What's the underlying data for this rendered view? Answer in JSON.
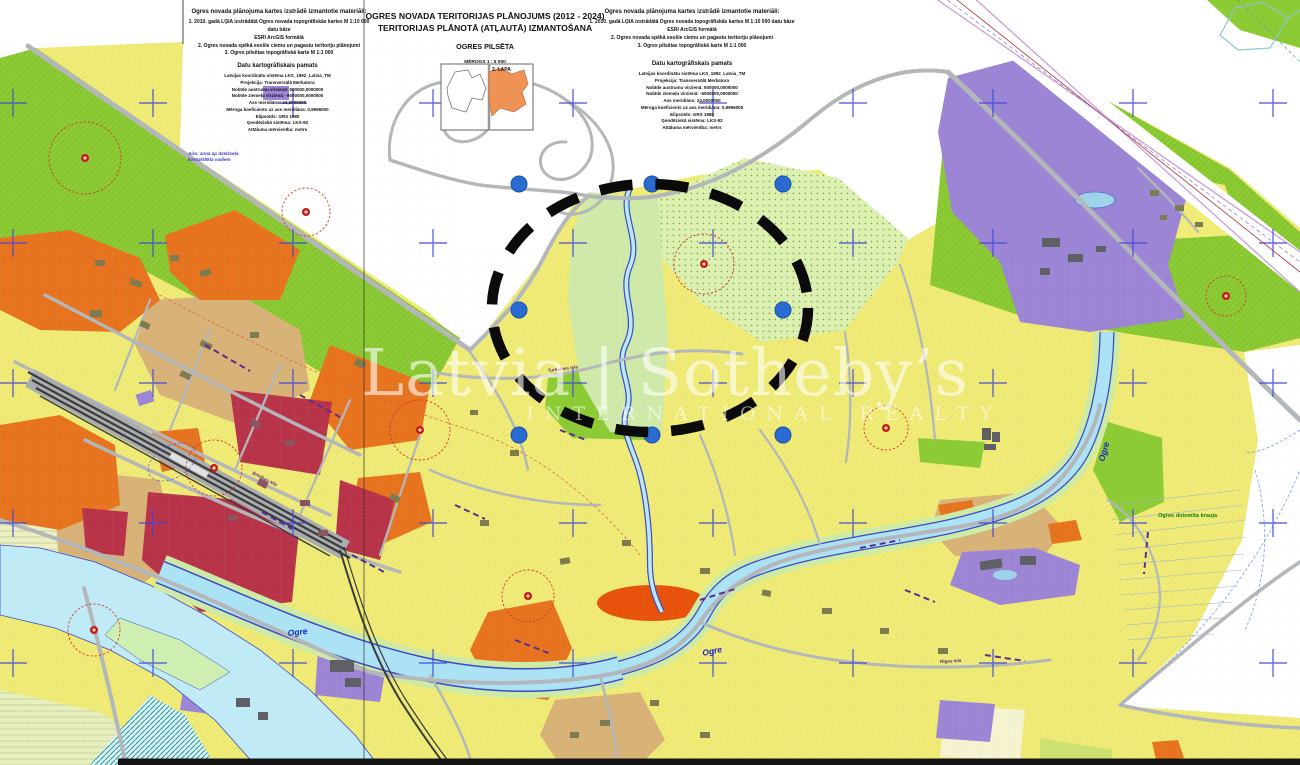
{
  "header": {
    "materials": {
      "title": "Ogres novada plānojuma kartes izstrādē izmantotie materiāli:",
      "lines": [
        "1. 2010. gadā LĢIA izstrādātā Ogres novada topogrāfiskās kartes M 1:10 000 datu bāze",
        "ESRI ArcGIS formātā",
        "2. Ogres novada spēkā esošie ciemu un pagastu teritoriju plānojumi",
        "3. Ogres pilsētas topogrāfiskā karte M 1:1 000"
      ]
    },
    "basis": {
      "title": "Datu kartogrāfiskais pamats",
      "lines": [
        "Latvijas koordinātu sistēma LKS_1992_Latvia_TM",
        "Projekcija: Transversālā Merkatora",
        "Nobīde austrumu virzienā: 500000,0000000",
        "Nobīde ziemeļu virzienā: -6000000,0000000",
        "Ass meridiāns: 24,0000000",
        "Mēroga koeficients uz ass meridiāna: 0,9996000",
        "Elipsoīds: GRS 1980",
        "Ģeodēziskā sistēma: LKS-92",
        "Attāluma mērvienība: metrs"
      ]
    },
    "title_block": {
      "line1": "OGRES NOVADA TERITORIJAS PLĀNOJUMS (2012 - 2024)",
      "line2": "TERITORIJAS PLĀNOTĀ (ATĻAUTĀ) IZMANTOŠANA",
      "subtitle": "OGRES PILSĒTA",
      "scale": "MĒROGS 1 : 5 000"
    },
    "inset_label": "2. LAPA"
  },
  "watermark": {
    "brand": "Latvia | Sotheby’s",
    "tagline": "INTERNATIONAL REALTY"
  },
  "map_labels": {
    "river_ogre_west": "Ogre",
    "river_ogre_mid": "Ogre",
    "river_ogre_east": "Ogre",
    "cliff": "Ogres dolomīta krauja",
    "note_line1": "Aizs. zona ap dzelzceļa",
    "note_line2": "kontakttīkla vadiem",
    "street_1": "Turkalnes iela",
    "street_2": "Brīvības iela",
    "street_3": "Rīgas iela"
  },
  "palette": {
    "residential_yellow": "#f0ec77",
    "greenery": "#8ccb33",
    "pale_green_dotted": "#ddf0b2",
    "mixed_orange": "#e8731e",
    "center_crimson": "#b83347",
    "tan_zone": "#d8b277",
    "institution_purple": "#9d85d6",
    "water_cyan": "#bfeaf6",
    "river_blue_edge": "#3c49c8",
    "road_gray": "#b3b7b9",
    "railway_dark": "#3b3b3b",
    "grid_cross_blue": "#4146d6",
    "marker_dot_blue": "#2a6bd2",
    "heritage_red": "#d93425",
    "annotation_black": "#0b0b0b"
  }
}
